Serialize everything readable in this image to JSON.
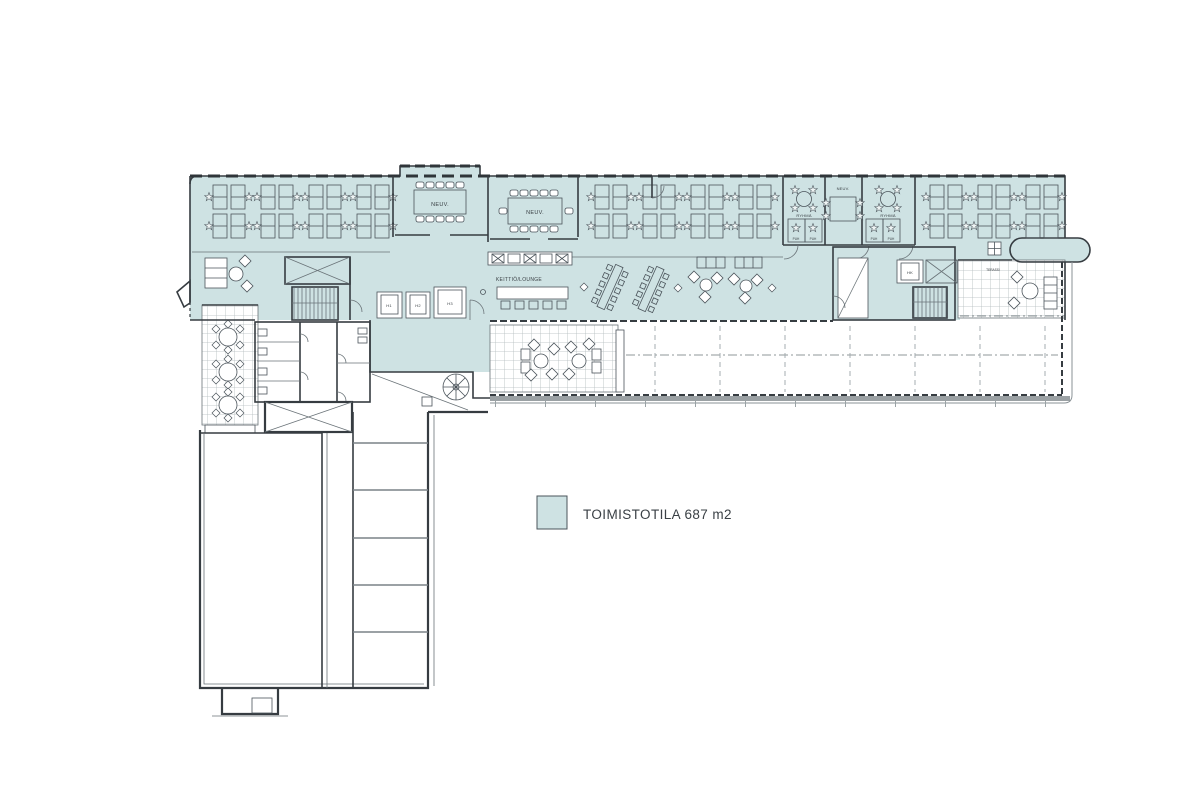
{
  "colors": {
    "office_fill": "#cee2e3",
    "wall": "#363c41",
    "furniture": "#4b545b",
    "grid": "#b3babd",
    "band_gray": "#9ba1a4"
  },
  "legend": {
    "label": "TOIMISTOTILA 687 m2",
    "swatch_color": "#cee2e3"
  },
  "rooms": {
    "meeting_top": "NEUV.",
    "meeting_mid": "NEUV.",
    "meeting_small": "NEUV.",
    "group_left": "RYHMÄ",
    "group_right": "RYHMÄ",
    "phone": "PUH",
    "kitchen_lounge": "KEITTIÖ/LOUNGE",
    "terrace": "TERASSI"
  },
  "elevators": {
    "e1": "H1",
    "e2": "H2",
    "e3": "H3",
    "service": "HK"
  }
}
